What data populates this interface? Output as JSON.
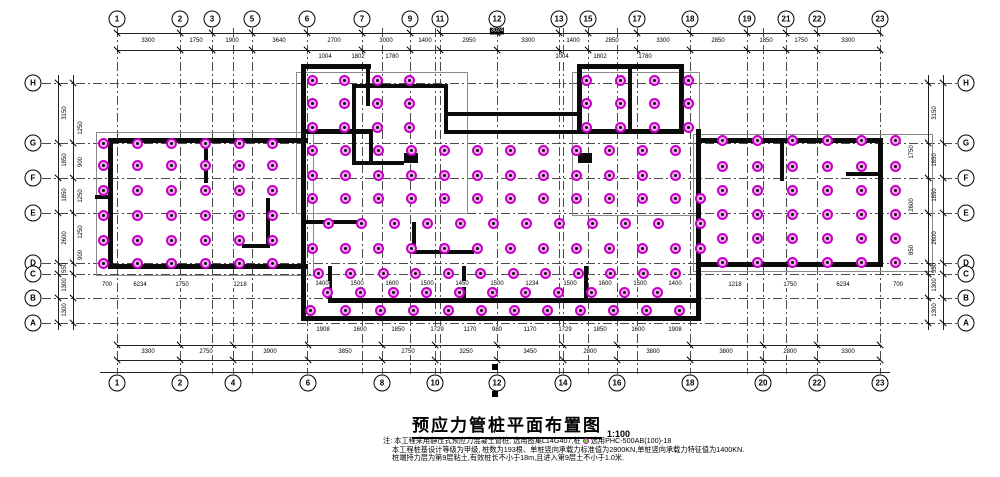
{
  "title": {
    "text": "预应力管桩平面布置图",
    "scale": "1:100"
  },
  "notes": {
    "lines": [
      {
        "pre": "注: 本工程采用静压式预应力混凝土管桩; 选用图集L14G407,桩",
        "icon": "pile-symbol",
        "post": "选用PHC-500AB(100)-18"
      },
      {
        "pre": "本工程桩基设计等级为甲级, 桩数为193根、单桩竖向承载力标准值为2800KN,单桩竖向承载力特征值为1400KN.",
        "icon": null,
        "post": ""
      },
      {
        "pre": "桩端持力层为第9层粘土,有效桩长不小于18m,且进入第9层土不小于1.0米.",
        "icon": null,
        "post": ""
      }
    ]
  },
  "colors": {
    "pile_ring": "#c300c3",
    "pile_fill": "#f2aff2",
    "wall": "#0b0b0b",
    "grid": "#4a4a4a",
    "dim": "#222222",
    "background": "#ffffff"
  },
  "axes": {
    "top_cy": 19,
    "bottom_cy": 383,
    "left_cx": 33,
    "right_cx": 966,
    "top": [
      {
        "label": "1",
        "x": 117
      },
      {
        "label": "2",
        "x": 180
      },
      {
        "label": "3",
        "x": 212
      },
      {
        "label": "5",
        "x": 252
      },
      {
        "label": "6",
        "x": 307
      },
      {
        "label": "7",
        "x": 362
      },
      {
        "label": "9",
        "x": 410
      },
      {
        "label": "11",
        "x": 440
      },
      {
        "label": "12",
        "x": 497
      },
      {
        "label": "13",
        "x": 559
      },
      {
        "label": "15",
        "x": 588
      },
      {
        "label": "17",
        "x": 637
      },
      {
        "label": "18",
        "x": 690
      },
      {
        "label": "19",
        "x": 747
      },
      {
        "label": "21",
        "x": 786
      },
      {
        "label": "22",
        "x": 817
      },
      {
        "label": "23",
        "x": 880
      }
    ],
    "bottom": [
      {
        "label": "1",
        "x": 117
      },
      {
        "label": "2",
        "x": 180
      },
      {
        "label": "4",
        "x": 233
      },
      {
        "label": "6",
        "x": 308
      },
      {
        "label": "8",
        "x": 382
      },
      {
        "label": "10",
        "x": 435
      },
      {
        "label": "12",
        "x": 497
      },
      {
        "label": "14",
        "x": 563
      },
      {
        "label": "16",
        "x": 617
      },
      {
        "label": "18",
        "x": 690
      },
      {
        "label": "20",
        "x": 763
      },
      {
        "label": "22",
        "x": 817
      },
      {
        "label": "23",
        "x": 880
      }
    ],
    "left": [
      {
        "label": "H",
        "y": 83
      },
      {
        "label": "G",
        "y": 143
      },
      {
        "label": "F",
        "y": 178
      },
      {
        "label": "E",
        "y": 213
      },
      {
        "label": "D",
        "y": 263
      },
      {
        "label": "C",
        "y": 274
      },
      {
        "label": "B",
        "y": 298
      },
      {
        "label": "A",
        "y": 323
      }
    ],
    "right": [
      {
        "label": "H",
        "y": 83
      },
      {
        "label": "G",
        "y": 143
      },
      {
        "label": "F",
        "y": 178
      },
      {
        "label": "E",
        "y": 213
      },
      {
        "label": "D",
        "y": 263
      },
      {
        "label": "C",
        "y": 274
      },
      {
        "label": "B",
        "y": 298
      },
      {
        "label": "A",
        "y": 323
      }
    ]
  },
  "grid": {
    "v": [
      117,
      180,
      212,
      233,
      252,
      307,
      362,
      382,
      410,
      435,
      440,
      497,
      559,
      563,
      588,
      617,
      637,
      690,
      747,
      763,
      786,
      817,
      880
    ],
    "h": [
      83,
      143,
      178,
      213,
      263,
      274,
      298,
      323
    ],
    "v_top": 28,
    "v_bottom": 374,
    "h_left": 42,
    "h_right": 957
  },
  "dim_lines": [
    {
      "o": "h",
      "y": 33,
      "x1": 117,
      "x2": 880,
      "ticks": [
        117,
        180,
        212,
        252,
        307,
        362,
        410,
        440,
        497,
        559,
        588,
        637,
        690,
        747,
        786,
        817,
        880
      ]
    },
    {
      "o": "h",
      "y": 50,
      "x1": 117,
      "x2": 880,
      "ticks": [
        117,
        180,
        212,
        252,
        307,
        362,
        410,
        440,
        497,
        559,
        588,
        637,
        690,
        747,
        786,
        817,
        880
      ]
    },
    {
      "o": "h",
      "y": 345,
      "x1": 117,
      "x2": 880,
      "ticks": [
        117,
        180,
        233,
        308,
        382,
        435,
        497,
        563,
        617,
        690,
        763,
        817,
        880
      ]
    },
    {
      "o": "h",
      "y": 360,
      "x1": 117,
      "x2": 880,
      "ticks": [
        117,
        180,
        233,
        308,
        382,
        435,
        497,
        563,
        617,
        690,
        763,
        817,
        880
      ]
    },
    {
      "o": "h",
      "y": 372,
      "x1": 100,
      "x2": 890,
      "ticks": []
    },
    {
      "o": "v",
      "x": 58,
      "y1": 75,
      "y2": 330,
      "ticks": [
        83,
        143,
        178,
        213,
        263,
        274,
        298,
        323
      ]
    },
    {
      "o": "v",
      "x": 73,
      "y1": 75,
      "y2": 330,
      "ticks": [
        83,
        143,
        178,
        213,
        263,
        274,
        298,
        323
      ]
    },
    {
      "o": "v",
      "x": 928,
      "y1": 75,
      "y2": 330,
      "ticks": [
        83,
        143,
        178,
        213,
        263,
        274,
        298,
        323
      ]
    },
    {
      "o": "v",
      "x": 943,
      "y1": 75,
      "y2": 330,
      "ticks": [
        83,
        143,
        178,
        213,
        263,
        274,
        298,
        323
      ]
    }
  ],
  "dim_labels": [
    {
      "x": 148,
      "y": 41,
      "t": "3300"
    },
    {
      "x": 196,
      "y": 41,
      "t": "1750"
    },
    {
      "x": 232,
      "y": 41,
      "t": "1900"
    },
    {
      "x": 279,
      "y": 41,
      "t": "3640"
    },
    {
      "x": 334,
      "y": 41,
      "t": "2700"
    },
    {
      "x": 386,
      "y": 41,
      "t": "3000"
    },
    {
      "x": 425,
      "y": 41,
      "t": "1400"
    },
    {
      "x": 469,
      "y": 41,
      "t": "2950"
    },
    {
      "x": 528,
      "y": 41,
      "t": "3300"
    },
    {
      "x": 573,
      "y": 41,
      "t": "1400"
    },
    {
      "x": 612,
      "y": 41,
      "t": "2850"
    },
    {
      "x": 663,
      "y": 41,
      "t": "3300"
    },
    {
      "x": 718,
      "y": 41,
      "t": "2850"
    },
    {
      "x": 766,
      "y": 41,
      "t": "1850"
    },
    {
      "x": 801,
      "y": 41,
      "t": "1750"
    },
    {
      "x": 848,
      "y": 41,
      "t": "3300"
    },
    {
      "x": 325,
      "y": 57,
      "t": "1004"
    },
    {
      "x": 358,
      "y": 57,
      "t": "1802"
    },
    {
      "x": 392,
      "y": 57,
      "t": "1780"
    },
    {
      "x": 562,
      "y": 57,
      "t": "1004"
    },
    {
      "x": 600,
      "y": 57,
      "t": "1802"
    },
    {
      "x": 645,
      "y": 57,
      "t": "1780"
    },
    {
      "x": 148,
      "y": 352,
      "t": "3300"
    },
    {
      "x": 206,
      "y": 352,
      "t": "2750"
    },
    {
      "x": 270,
      "y": 352,
      "t": "3900"
    },
    {
      "x": 345,
      "y": 352,
      "t": "3850"
    },
    {
      "x": 408,
      "y": 352,
      "t": "2750"
    },
    {
      "x": 466,
      "y": 352,
      "t": "3250"
    },
    {
      "x": 530,
      "y": 352,
      "t": "3450"
    },
    {
      "x": 590,
      "y": 352,
      "t": "2800"
    },
    {
      "x": 653,
      "y": 352,
      "t": "3800"
    },
    {
      "x": 726,
      "y": 352,
      "t": "3800"
    },
    {
      "x": 790,
      "y": 352,
      "t": "2800"
    },
    {
      "x": 848,
      "y": 352,
      "t": "3300"
    },
    {
      "x": 65,
      "y": 113,
      "t": "3150",
      "r": 1
    },
    {
      "x": 65,
      "y": 160,
      "t": "1850",
      "r": 1
    },
    {
      "x": 65,
      "y": 195,
      "t": "1850",
      "r": 1
    },
    {
      "x": 65,
      "y": 238,
      "t": "2600",
      "r": 1
    },
    {
      "x": 65,
      "y": 268,
      "t": "550",
      "r": 1
    },
    {
      "x": 65,
      "y": 285,
      "t": "1300",
      "r": 1
    },
    {
      "x": 65,
      "y": 310,
      "t": "1300",
      "r": 1
    },
    {
      "x": 81,
      "y": 128,
      "t": "1250",
      "r": 1
    },
    {
      "x": 81,
      "y": 162,
      "t": "900",
      "r": 1
    },
    {
      "x": 81,
      "y": 196,
      "t": "1250",
      "r": 1
    },
    {
      "x": 81,
      "y": 232,
      "t": "1250",
      "r": 1
    },
    {
      "x": 81,
      "y": 255,
      "t": "900",
      "r": 1
    },
    {
      "x": 935,
      "y": 113,
      "t": "3150",
      "r": 1
    },
    {
      "x": 935,
      "y": 160,
      "t": "1850",
      "r": 1
    },
    {
      "x": 935,
      "y": 195,
      "t": "1850",
      "r": 1
    },
    {
      "x": 935,
      "y": 238,
      "t": "2600",
      "r": 1
    },
    {
      "x": 935,
      "y": 268,
      "t": "550",
      "r": 1
    },
    {
      "x": 935,
      "y": 285,
      "t": "1300",
      "r": 1
    },
    {
      "x": 935,
      "y": 310,
      "t": "1300",
      "r": 1
    },
    {
      "x": 912,
      "y": 152,
      "t": "1750",
      "r": 1
    },
    {
      "x": 912,
      "y": 205,
      "t": "2600",
      "r": 1
    },
    {
      "x": 912,
      "y": 250,
      "t": "850",
      "r": 1
    },
    {
      "x": 322,
      "y": 284,
      "t": "1400"
    },
    {
      "x": 357,
      "y": 284,
      "t": "1500"
    },
    {
      "x": 392,
      "y": 284,
      "t": "1600"
    },
    {
      "x": 427,
      "y": 284,
      "t": "1500"
    },
    {
      "x": 462,
      "y": 284,
      "t": "1450"
    },
    {
      "x": 497,
      "y": 284,
      "t": "1500"
    },
    {
      "x": 532,
      "y": 284,
      "t": "1234"
    },
    {
      "x": 570,
      "y": 284,
      "t": "1500"
    },
    {
      "x": 605,
      "y": 284,
      "t": "1600"
    },
    {
      "x": 640,
      "y": 284,
      "t": "1500"
    },
    {
      "x": 675,
      "y": 284,
      "t": "1400"
    },
    {
      "x": 323,
      "y": 330,
      "t": "1908"
    },
    {
      "x": 360,
      "y": 330,
      "t": "1600"
    },
    {
      "x": 398,
      "y": 330,
      "t": "1850"
    },
    {
      "x": 437,
      "y": 330,
      "t": "1729"
    },
    {
      "x": 470,
      "y": 330,
      "t": "1170"
    },
    {
      "x": 497,
      "y": 330,
      "t": "980"
    },
    {
      "x": 530,
      "y": 330,
      "t": "1170"
    },
    {
      "x": 565,
      "y": 330,
      "t": "1729"
    },
    {
      "x": 600,
      "y": 330,
      "t": "1850"
    },
    {
      "x": 638,
      "y": 330,
      "t": "1600"
    },
    {
      "x": 675,
      "y": 330,
      "t": "1908"
    },
    {
      "x": 107,
      "y": 285,
      "t": "700"
    },
    {
      "x": 140,
      "y": 285,
      "t": "6234"
    },
    {
      "x": 182,
      "y": 285,
      "t": "1750"
    },
    {
      "x": 240,
      "y": 285,
      "t": "1218"
    },
    {
      "x": 735,
      "y": 285,
      "t": "1218"
    },
    {
      "x": 790,
      "y": 285,
      "t": "1750"
    },
    {
      "x": 843,
      "y": 285,
      "t": "6234"
    },
    {
      "x": 898,
      "y": 285,
      "t": "700"
    }
  ],
  "highlights": [
    {
      "x": 497,
      "y": 31,
      "t": "3024"
    },
    {
      "x": 495,
      "y": 367,
      "t": ""
    },
    {
      "x": 495,
      "y": 394,
      "t": ""
    }
  ],
  "building": {
    "outlines": [
      [
        96,
        132,
        216,
        142
      ],
      [
        693,
        134,
        238,
        136
      ],
      [
        296,
        72,
        170,
        140
      ],
      [
        572,
        72,
        126,
        142
      ]
    ],
    "walls": [
      [
        108,
        138,
        200,
        5
      ],
      [
        108,
        138,
        5,
        131
      ],
      [
        108,
        264,
        200,
        5
      ],
      [
        204,
        141,
        4,
        42
      ],
      [
        95,
        195,
        16,
        4
      ],
      [
        266,
        198,
        4,
        50
      ],
      [
        242,
        244,
        28,
        4
      ],
      [
        301,
        64,
        70,
        5
      ],
      [
        301,
        64,
        5,
        70
      ],
      [
        366,
        64,
        4,
        42
      ],
      [
        301,
        129,
        72,
        5
      ],
      [
        352,
        84,
        96,
        4
      ],
      [
        352,
        88,
        4,
        77
      ],
      [
        444,
        84,
        4,
        50
      ],
      [
        352,
        161,
        52,
        4
      ],
      [
        369,
        129,
        4,
        36
      ],
      [
        404,
        153,
        14,
        10
      ],
      [
        301,
        129,
        5,
        192
      ],
      [
        301,
        316,
        400,
        5
      ],
      [
        444,
        130,
        140,
        4
      ],
      [
        696,
        129,
        5,
        192
      ],
      [
        444,
        112,
        137,
        4
      ],
      [
        444,
        112,
        4,
        22
      ],
      [
        577,
        112,
        4,
        22
      ],
      [
        301,
        220,
        58,
        4
      ],
      [
        412,
        222,
        4,
        32
      ],
      [
        412,
        250,
        62,
        4
      ],
      [
        328,
        298,
        372,
        5
      ],
      [
        328,
        266,
        4,
        36
      ],
      [
        462,
        266,
        4,
        36
      ],
      [
        584,
        266,
        4,
        36
      ],
      [
        577,
        64,
        107,
        5
      ],
      [
        577,
        64,
        5,
        70
      ],
      [
        679,
        64,
        5,
        70
      ],
      [
        577,
        129,
        107,
        5
      ],
      [
        628,
        64,
        4,
        70
      ],
      [
        578,
        153,
        14,
        10
      ],
      [
        697,
        138,
        186,
        5
      ],
      [
        878,
        138,
        5,
        129
      ],
      [
        697,
        262,
        186,
        5
      ],
      [
        780,
        141,
        4,
        40
      ],
      [
        846,
        172,
        32,
        4
      ],
      [
        697,
        138,
        4,
        50
      ]
    ]
  },
  "piles": {
    "rows": [
      {
        "y": 80,
        "xs": [
          312,
          344,
          377,
          409,
          586,
          620,
          654,
          688
        ]
      },
      {
        "y": 103,
        "xs": [
          312,
          344,
          377,
          409,
          586,
          620,
          654,
          688
        ]
      },
      {
        "y": 127,
        "xs": [
          312,
          344,
          377,
          409,
          586,
          620,
          654,
          688
        ]
      },
      {
        "y": 143,
        "xs": [
          103,
          137,
          171,
          205,
          239,
          272
        ]
      },
      {
        "y": 150,
        "xs": [
          312,
          345,
          378,
          411,
          444,
          477,
          510,
          543,
          576,
          609,
          642,
          675
        ]
      },
      {
        "y": 140,
        "xs": [
          722,
          757,
          792,
          827,
          861,
          895
        ]
      },
      {
        "y": 165,
        "xs": [
          103,
          137,
          171,
          205,
          239,
          272
        ]
      },
      {
        "y": 175,
        "xs": [
          312,
          345,
          378,
          411,
          444,
          477,
          510,
          543,
          576,
          609,
          642,
          675
        ]
      },
      {
        "y": 166,
        "xs": [
          722,
          757,
          792,
          827,
          861,
          895
        ]
      },
      {
        "y": 190,
        "xs": [
          103,
          137,
          171,
          205,
          239,
          272
        ]
      },
      {
        "y": 198,
        "xs": [
          312,
          345,
          378,
          411,
          444,
          477,
          510,
          543,
          576,
          609,
          642,
          675,
          700
        ]
      },
      {
        "y": 190,
        "xs": [
          722,
          757,
          792,
          827,
          861,
          895
        ]
      },
      {
        "y": 215,
        "xs": [
          103,
          137,
          171,
          205,
          239,
          272
        ]
      },
      {
        "y": 223,
        "xs": [
          328,
          361,
          394,
          427,
          460,
          493,
          526,
          559,
          592,
          625,
          658,
          700
        ]
      },
      {
        "y": 214,
        "xs": [
          722,
          757,
          792,
          827,
          861,
          895
        ]
      },
      {
        "y": 240,
        "xs": [
          103,
          137,
          171,
          205,
          239,
          272
        ]
      },
      {
        "y": 248,
        "xs": [
          312,
          345,
          378,
          411,
          444,
          477,
          510,
          543,
          576,
          609,
          642,
          675,
          700
        ]
      },
      {
        "y": 238,
        "xs": [
          722,
          757,
          792,
          827,
          861,
          895
        ]
      },
      {
        "y": 263,
        "xs": [
          103,
          137,
          171,
          205,
          239,
          272
        ]
      },
      {
        "y": 262,
        "xs": [
          722,
          757,
          792,
          827,
          861,
          895
        ]
      },
      {
        "y": 273,
        "xs": [
          318,
          350,
          383,
          415,
          448,
          480,
          513,
          545,
          578,
          610,
          643,
          675
        ]
      },
      {
        "y": 292,
        "xs": [
          327,
          360,
          393,
          426,
          459,
          492,
          525,
          558,
          591,
          624,
          657
        ]
      },
      {
        "y": 310,
        "xs": [
          310,
          345,
          380,
          413,
          448,
          481,
          514,
          547,
          580,
          613,
          646,
          679
        ]
      }
    ]
  }
}
